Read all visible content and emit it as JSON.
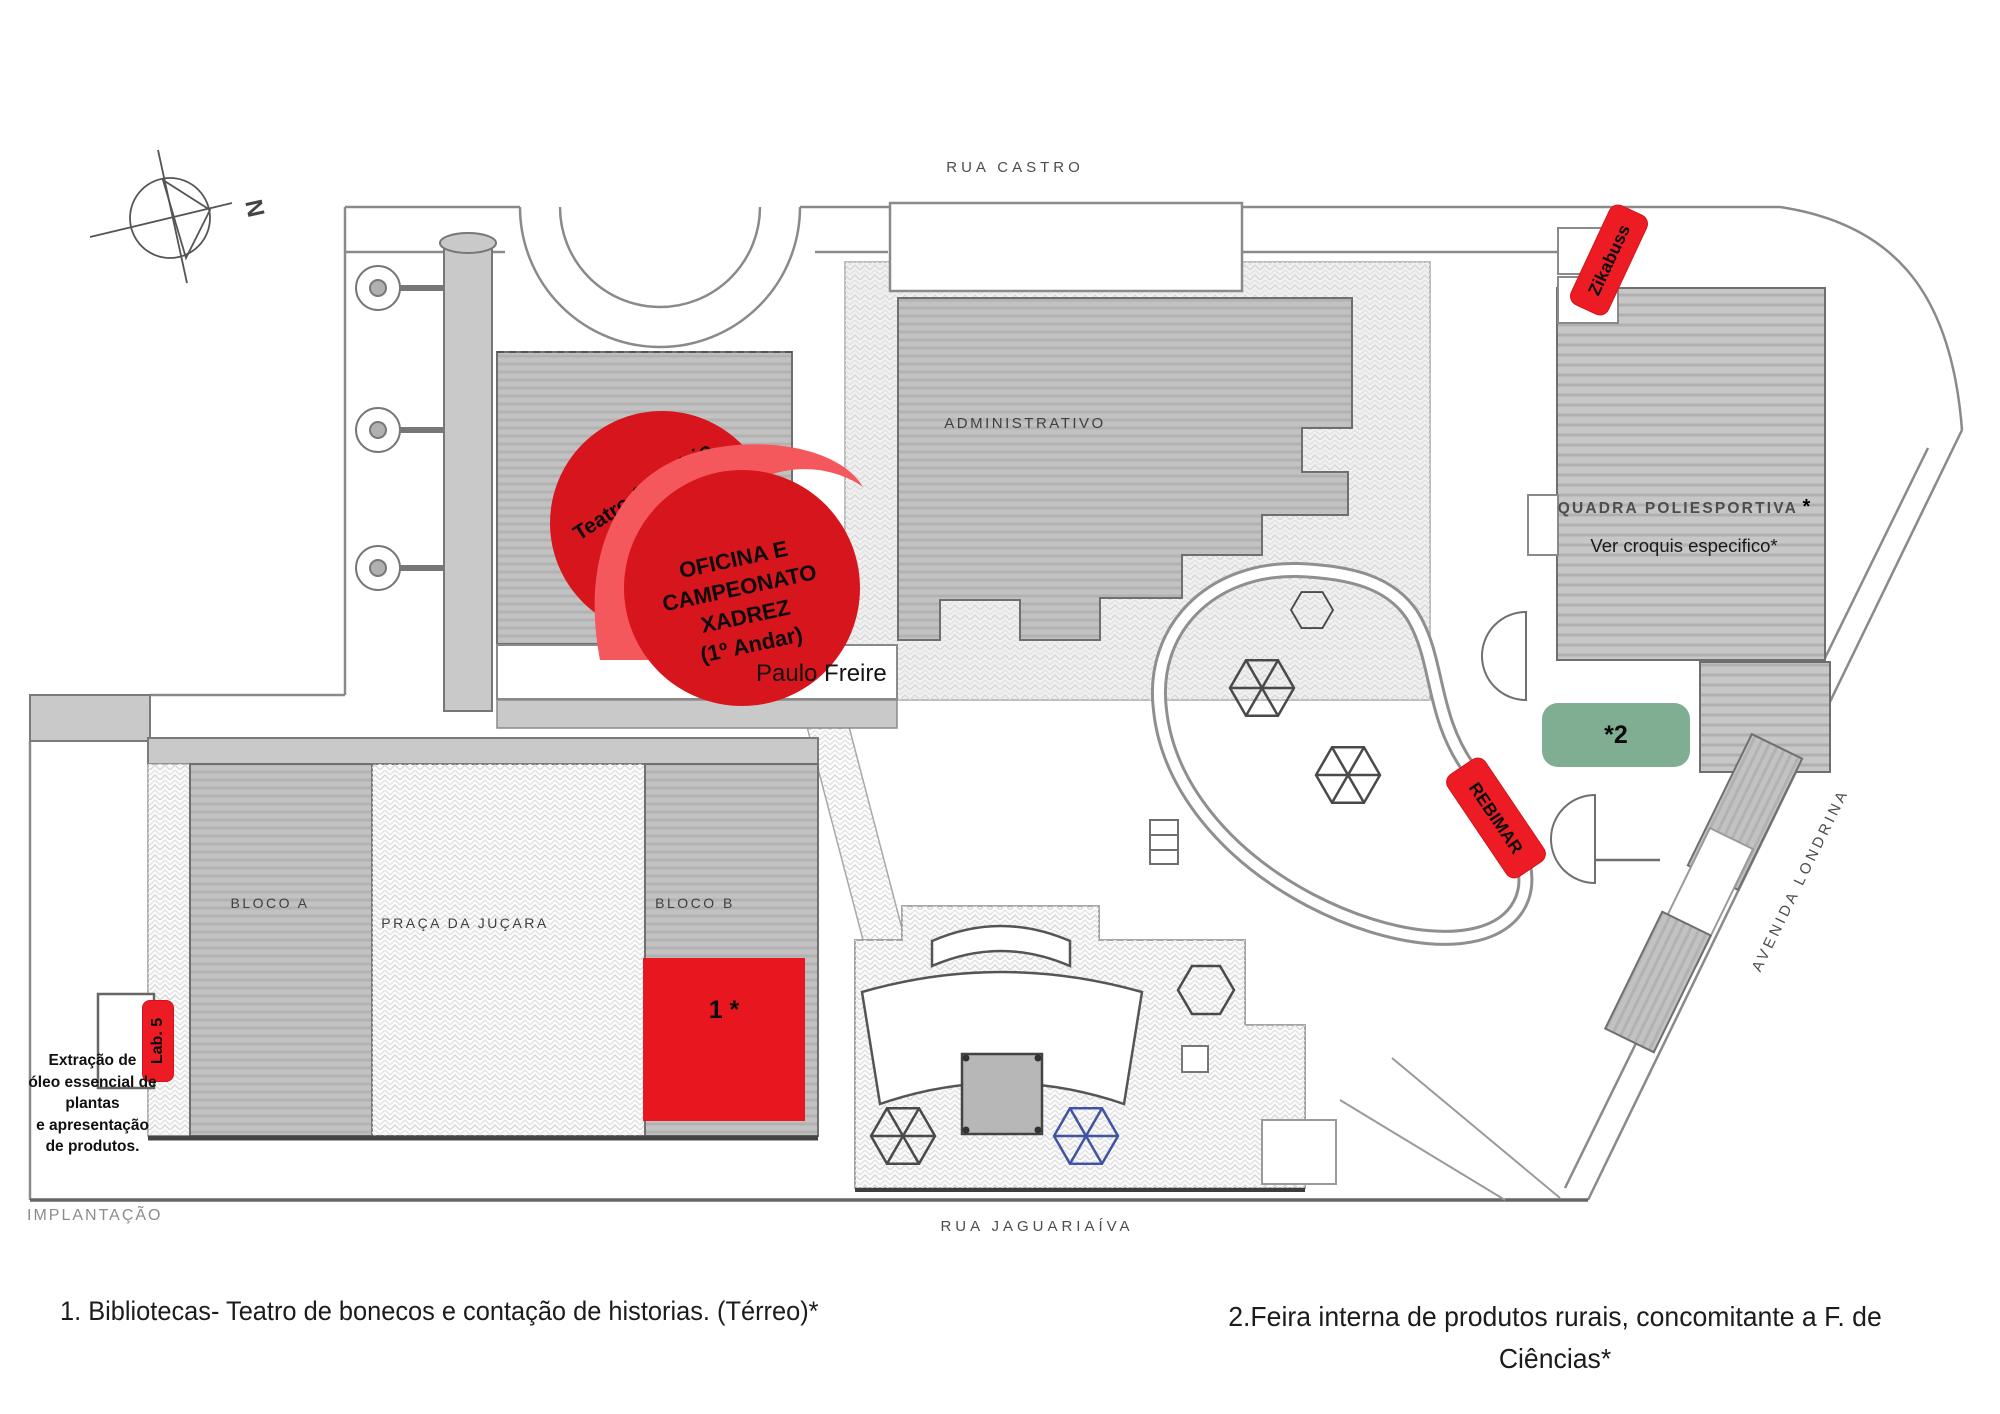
{
  "plan": {
    "title": "IMPLANTAÇÃO",
    "compass_label": "N",
    "streets": {
      "top": "RUA CASTRO",
      "bottom": "RUA JAGUARIAÍVA",
      "right": "AVENIDA LONDRINA"
    },
    "buildings": {
      "administrativo": "ADMINISTRATIVO",
      "bloco_a": "BLOCO A",
      "praca": "PRAÇA DA JUÇARA",
      "bloco_b": "BLOCO B",
      "quadra": "QUADRA POLIESPORTIVA",
      "quadra_star": "*",
      "quadra_note": "Ver croquis especifico*",
      "school_name": "Paulo Freire"
    }
  },
  "annotations": {
    "teatro_line1": "Teatro Auditório",
    "teatro_line2": "(Térreo)",
    "oficina_line1": "OFICINA E",
    "oficina_line2": "CAMPEONATO",
    "oficina_line3": "XADREZ",
    "oficina_line4": "(1º Andar)",
    "zikabuss": "Zikabuss",
    "rebimar": "REBIMAR",
    "lab5": "Lab. 5",
    "marker1": "1 *",
    "marker2": "*2",
    "extracao_line1": "Extração de",
    "extracao_line2": "óleo essencial de",
    "extracao_line3": "plantas",
    "extracao_line4": "e apresentação",
    "extracao_line5": "de produtos."
  },
  "legend": {
    "item1": "1. Bibliotecas- Teatro de bonecos e contação de historias. (Térreo)*",
    "item2_line1": "2.Feira interna de produtos rurais, concomitante a F. de",
    "item2_line2": "Ciências*"
  },
  "colors": {
    "annotation_red": "#ed1c24",
    "circle_red": "#d7151c",
    "light_red": "#f4575c",
    "square_red": "#e8171f",
    "green": "#7fae93"
  }
}
